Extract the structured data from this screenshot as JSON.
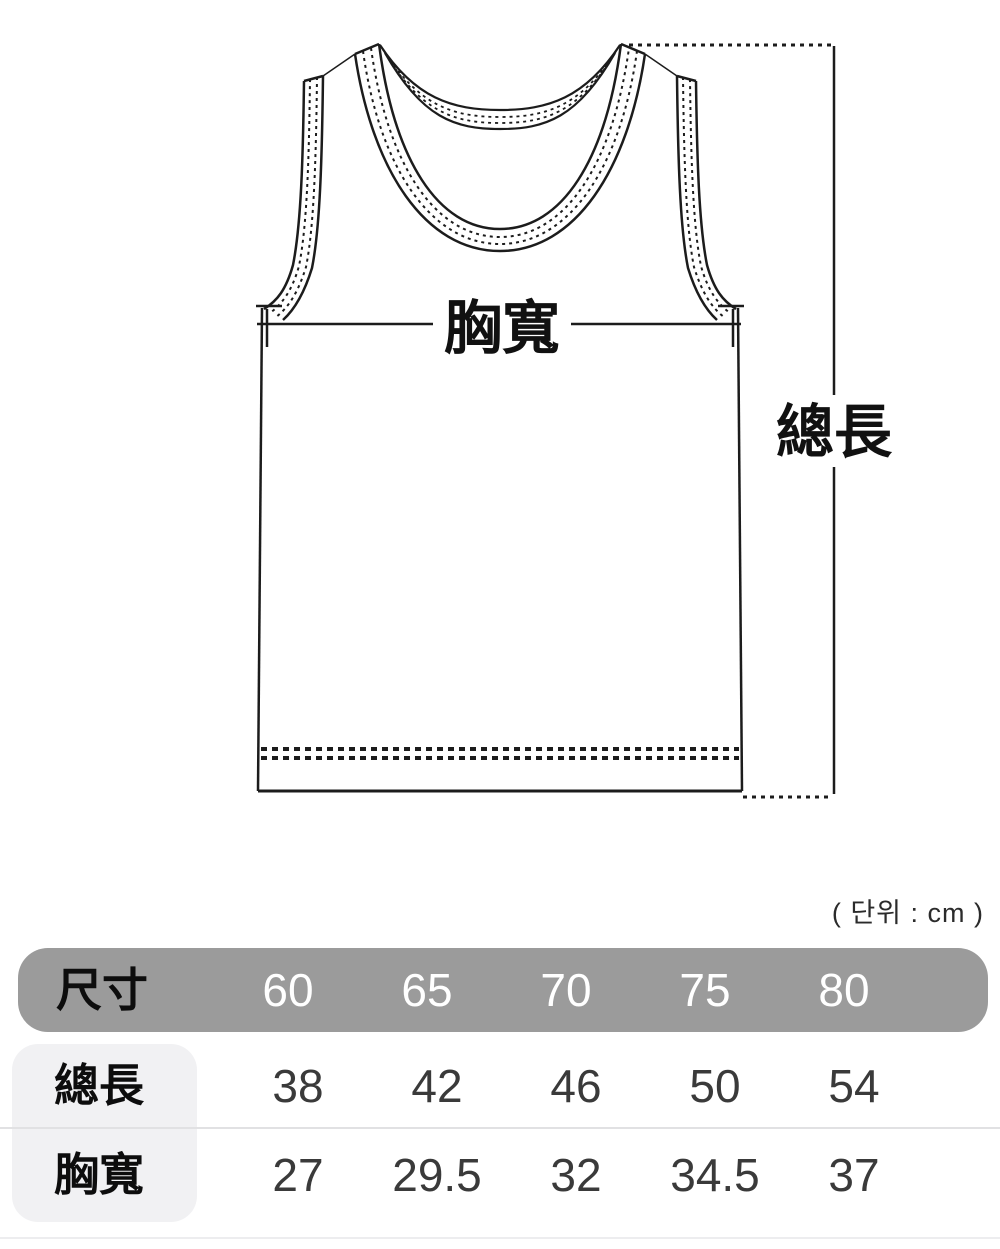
{
  "figure": {
    "chest_label": "胸寬",
    "length_label": "總長"
  },
  "unit_note": "( 단위 : cm )",
  "table": {
    "header_label": "尺寸",
    "columns": [
      "60",
      "65",
      "70",
      "75",
      "80"
    ],
    "rows": [
      {
        "label": "總長",
        "values": [
          "38",
          "42",
          "46",
          "50",
          "54"
        ]
      },
      {
        "label": "胸寬",
        "values": [
          "27",
          "29.5",
          "32",
          "34.5",
          "37"
        ]
      }
    ]
  },
  "chart_data": {
    "type": "table",
    "title": "tank-top size chart (cm)",
    "categories": [
      "60",
      "65",
      "70",
      "75",
      "80"
    ],
    "series": [
      {
        "name": "總長",
        "values": [
          38,
          42,
          46,
          50,
          54
        ]
      },
      {
        "name": "胸寬",
        "values": [
          27,
          29.5,
          32,
          34.5,
          37
        ]
      }
    ]
  },
  "colors": {
    "line": "#1c1c1c",
    "header_bg": "#9b9b9b",
    "header_text": "#ffffff",
    "label_bg": "#f1f1f3",
    "divider": "#e1e1e3"
  }
}
